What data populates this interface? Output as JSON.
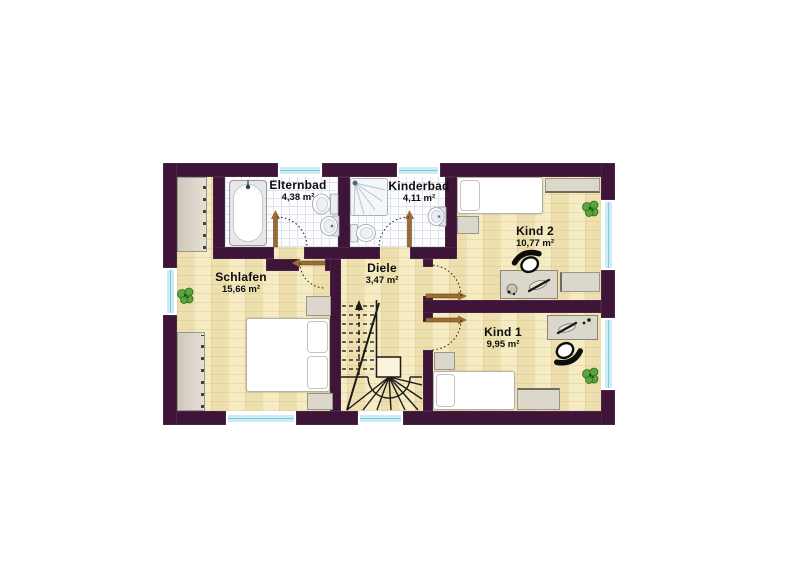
{
  "plan_title": "Obergeschoss Grundriss",
  "rooms": [
    {
      "id": "elternbad",
      "name": "Elternbad",
      "area": "4,38 m²",
      "furniture": [
        "bathtub",
        "toilet",
        "sink"
      ]
    },
    {
      "id": "kinderbad",
      "name": "Kinderbad",
      "area": "4,11 m²",
      "furniture": [
        "shower",
        "toilet",
        "sink"
      ]
    },
    {
      "id": "kind2",
      "name": "Kind 2",
      "area": "10,77 m²",
      "furniture": [
        "bed",
        "shelf",
        "nightstand",
        "desk",
        "desk-chair",
        "plant",
        "sideboard"
      ]
    },
    {
      "id": "schlafen",
      "name": "Schlafen",
      "area": "15,66 m²",
      "furniture": [
        "double-bed",
        "wardrobe",
        "wardrobe",
        "nightstand",
        "nightstand",
        "plant"
      ]
    },
    {
      "id": "diele",
      "name": "Diele",
      "area": "3,47 m²",
      "furniture": [
        "staircase-up"
      ]
    },
    {
      "id": "kind1",
      "name": "Kind 1",
      "area": "9,95 m²",
      "furniture": [
        "bed",
        "desk",
        "desk-chair",
        "nightstand",
        "dresser",
        "plant"
      ]
    }
  ],
  "colors": {
    "wall": "#3e1539",
    "floor_parquet": "#f6ecc3",
    "floor_tile": "#fdfdfe",
    "window_glass": "#cdedf6",
    "door_leaf": "#9c6b33",
    "plant": "#58a53f"
  }
}
